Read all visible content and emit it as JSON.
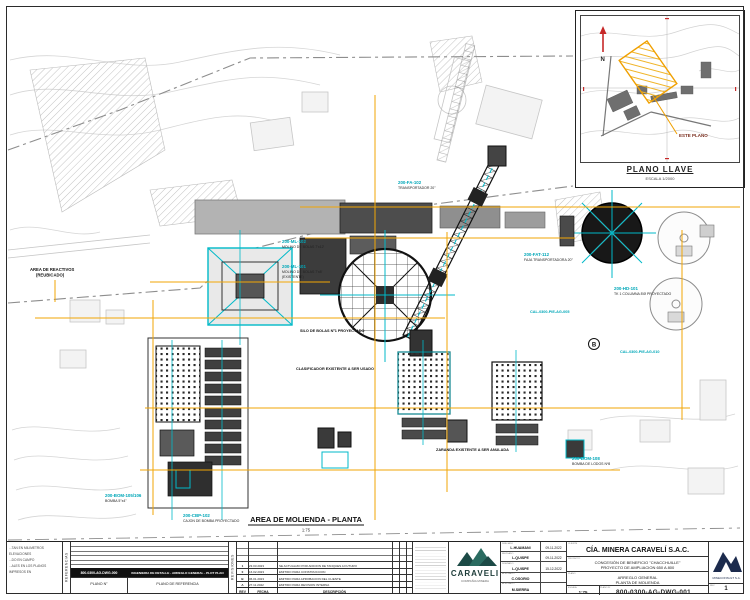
{
  "key_plan": {
    "title": "PLANO LLAVE",
    "scale": "ESCALA 1/2000",
    "callout": "ESTE PLANO",
    "north_label": "N"
  },
  "drawing": {
    "title": "AREA DE MOLIENDA - PLANTA",
    "scale": "1:75",
    "marker_b": "B",
    "labels": [
      {
        "tag": "200-FA-102",
        "desc": "TRANSPORTADOR 20\""
      },
      {
        "tag": "200-ML-102",
        "desc": "MOLINO DE BOLAS 7'x12'"
      },
      {
        "tag": "200-ML-101",
        "desc": "MOLINO DE BOLAS 7'x8'",
        "desc2": "(EXISTENTE)"
      },
      {
        "tag": "200-FAT-112",
        "desc": "FAJA TRANSPORTADORA 20°"
      },
      {
        "tag": "200-HD-101",
        "desc": "TK 1 COLUMNA 8'Ø PROYECTADO"
      },
      {
        "tag": "200-CBP-102",
        "desc": "CAJON DE BOMBA PROYECTADO"
      },
      {
        "tag": "200-BOM-105/106",
        "desc": "BOMBA 5\"x4\""
      },
      {
        "tag": "200-BOM-108",
        "desc": "BOMBA DE LODOS Nº8"
      },
      {
        "tag": "CAL-0300-PIE-AG-005",
        "desc": ""
      },
      {
        "tag": "CAL-0300-PIE-AG-010",
        "desc": ""
      }
    ],
    "black_labels": [
      "AREA DE REACTIVOS",
      "(REUBICADO)",
      "SILO DE BOLAS Nº1 PROYECTADO",
      "CLASIFICADOR EXISTENTE A SER USADO",
      "ZARANDA EXISTENTE A SER ANULADA"
    ]
  },
  "notes": {
    "line1": "...TAN EN MILIMETROS ELEVACIONES",
    "line2": "...DO EN CAMPO",
    "line3": "...ALES EN LOS PLANOS IMPRESOS EN"
  },
  "references": {
    "side_label": "REFERENCIAS",
    "row_number": "800-0300-AG-DWG-000",
    "row_desc": "INGENIERIA DE DETALLE - ARREGLO GENERAL - PLOT PLAN",
    "col1": "PLANO N°",
    "col2": "PLANO DE REFERENCIA"
  },
  "revisions": {
    "side_label": "REVISIONES",
    "col_rev": "REV",
    "col_fecha": "FECHA",
    "col_desc": "DESCRIPCIÓN",
    "rows": [
      {
        "rev": "1",
        "fecha": "23.03.2023",
        "desc": "SE ACTUALIZO POR ADICION DE TANQUES A FUTURO"
      },
      {
        "rev": "0",
        "fecha": "16.02.2023",
        "desc": "EMITIDO PARA CONSTRUCCION"
      },
      {
        "rev": "B",
        "fecha": "06.01.2023",
        "desc": "EMITIDO PARA APROBACION DEL CLIENTE"
      },
      {
        "rev": "A",
        "fecha": "27.11.2022",
        "desc": "EMITIDO PARA REVISION INTERNA"
      }
    ]
  },
  "title_block": {
    "client_label": "CLIENTE",
    "company": "CÍA. MINERA CARAVELÍ S.A.C.",
    "project_label": "PROYECTO",
    "project_line1": "CONCESIÓN DE BENEFICIO \"CHACCHUILLE\"",
    "project_line2": "PROYECTO DE AMPLIACION 650 A 800",
    "plano_label": "PLANO",
    "plano_line1": "ARREGLO GENERAL",
    "plano_line2": "PLANTA DE MOLIENDA",
    "escala_label": "ESCALA",
    "escala_value": "1:75",
    "plano_n_label": "PLANO N°",
    "drawing_number": "800-0300-AG-DWG-001",
    "rev_label": "REV.",
    "rev_value": "1",
    "caraveli_name": "CARAVELI",
    "caraveli_sub": "COMPAÑIA MINERA",
    "mineconsult": "MINECONSULT S.A.",
    "signatures": [
      {
        "label": "DIBUJADO",
        "name": "L.HUAMANI",
        "date": "09-11-2022"
      },
      {
        "label": "REVISADO",
        "name": "L.QUISPE",
        "date": "09-11-2022"
      },
      {
        "label": "DISEÑADO",
        "name": "L.QUISPE",
        "date": "15-12-2022"
      },
      {
        "label": "APROBADO",
        "name": "C.OSORIO",
        "date": ""
      },
      {
        "label": "APROBADO",
        "name": "M.SIERRA",
        "date": ""
      }
    ]
  },
  "colors": {
    "cyan": "#00b9c8",
    "yellow": "#f2a605",
    "hatch_yellow": "#f0b428",
    "red": "#c62828",
    "logo_teal": "#1c4a46",
    "logo_navy": "#1c2b4d"
  }
}
